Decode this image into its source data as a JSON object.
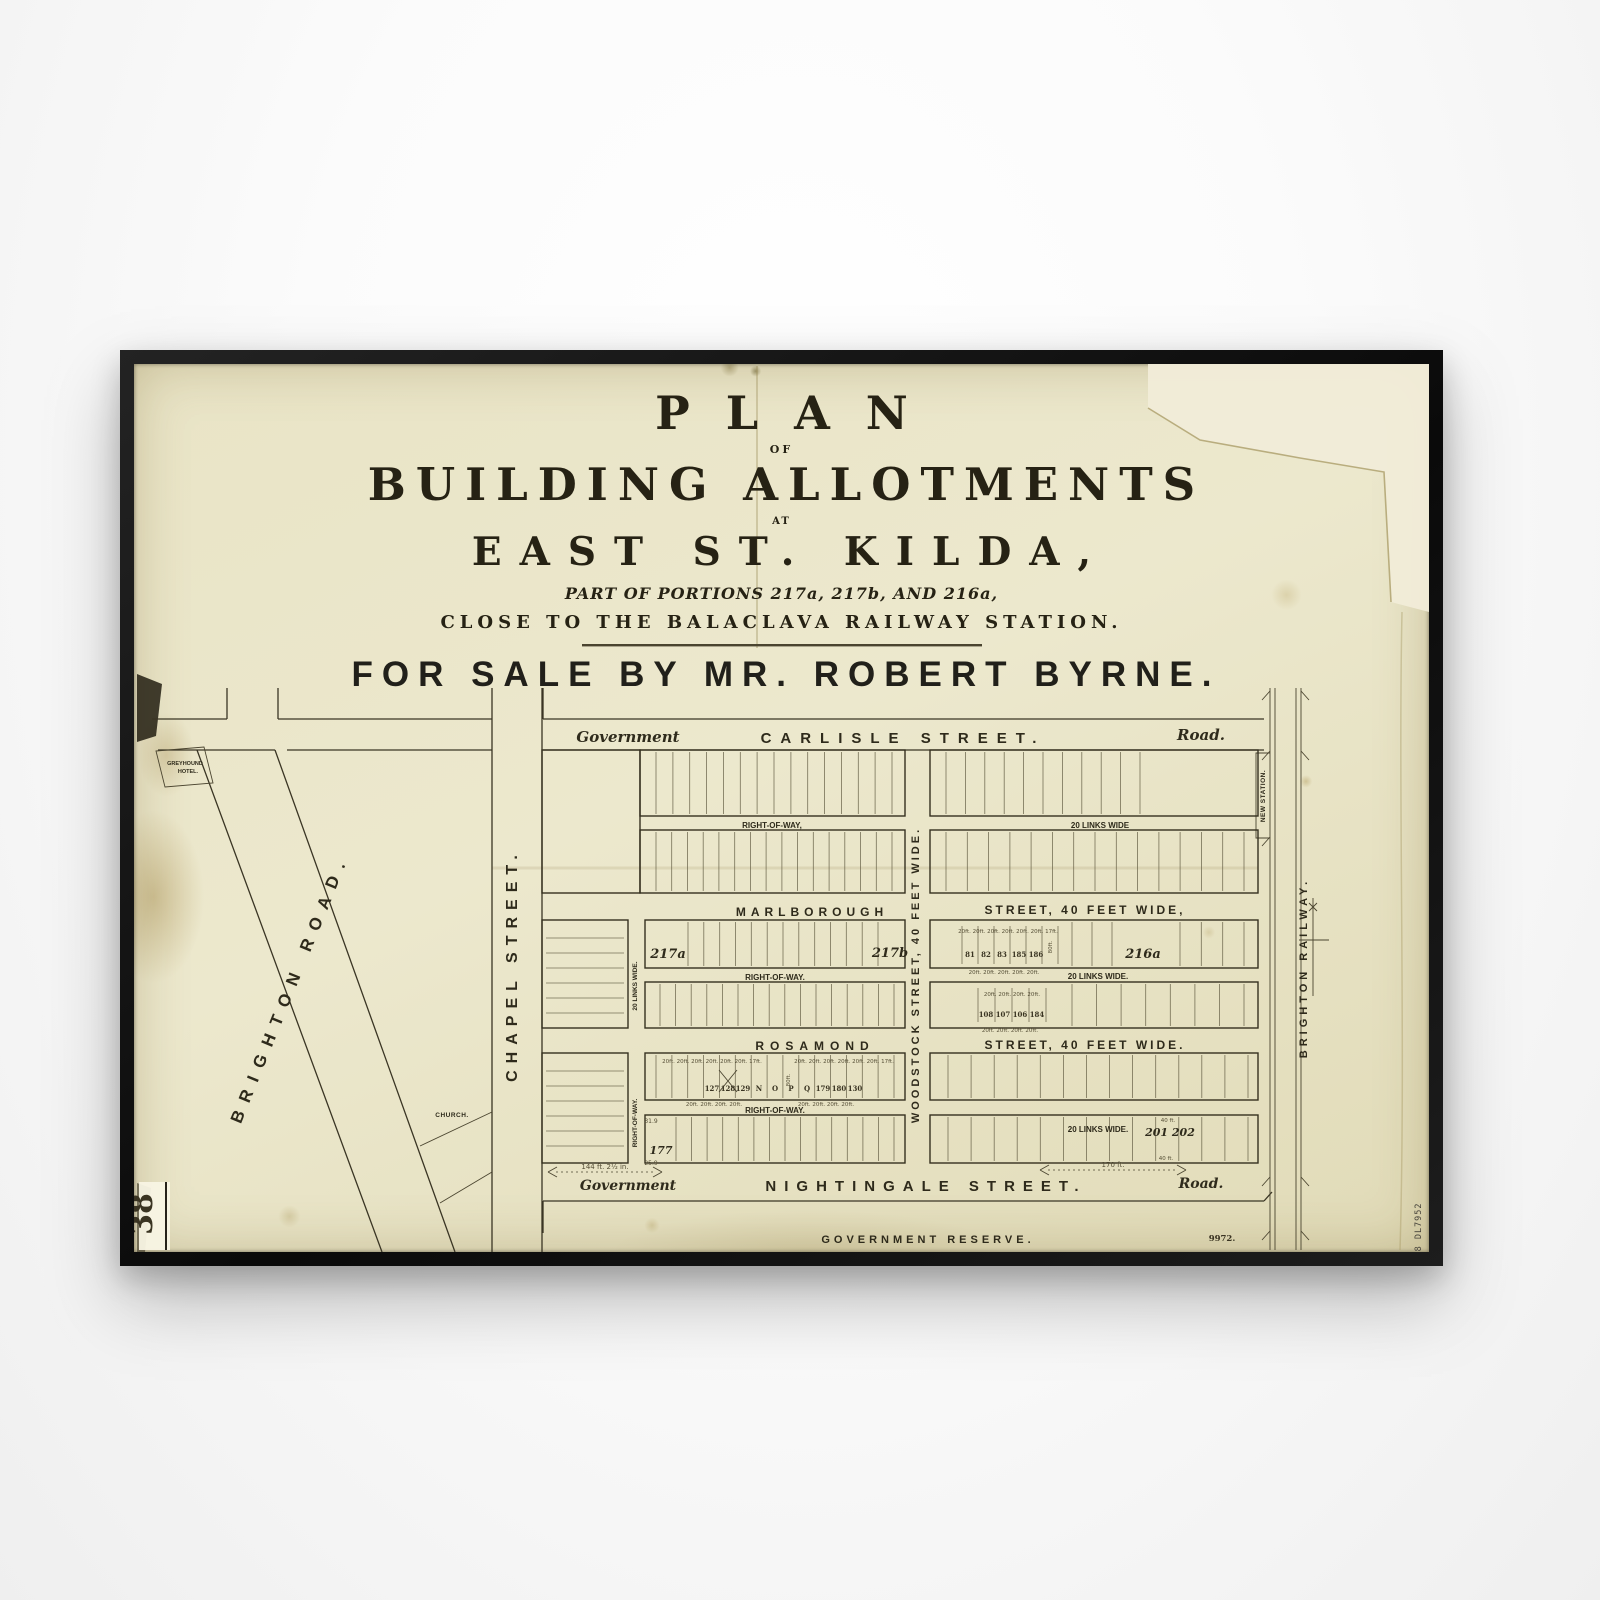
{
  "poster": {
    "title": {
      "plan": "PLAN",
      "of": "OF",
      "building_allotments": "BUILDING ALLOTMENTS",
      "at": "AT",
      "location": "EAST ST. KILDA,",
      "portions": "PART OF PORTIONS 217a, 217b, AND 216a,",
      "station_note": "CLOSE TO THE BALACLAVA RAILWAY STATION.",
      "sale_line": "FOR SALE BY MR. ROBERT BYRNE."
    },
    "streets": {
      "carlisle": "CARLISLE STREET.",
      "marlborough": "MARLBOROUGH",
      "marlborough_suffix": "STREET, 40 FEET WIDE,",
      "rosamond": "ROSAMOND",
      "rosamond_suffix": "STREET, 40 FEET WIDE.",
      "nightingale": "NIGHTINGALE STREET.",
      "woodstock": "WOODSTOCK STREET, 40 FEET WIDE.",
      "chapel": "CHAPEL STREET.",
      "brighton_road": "BRIGHTON ROAD.",
      "brighton_railway": "BRIGHTON RAILWAY.",
      "government": "Government",
      "road": "Road.",
      "government_reserve": "GOVERNMENT RESERVE."
    },
    "annotations": {
      "right_of_way_comma": "RIGHT-OF-WAY,",
      "right_of_way": "RIGHT-OF-WAY.",
      "links_wide": "20 LINKS WIDE",
      "links_wide_dot": "20 LINKS WIDE.",
      "new_station": "NEW STATION.",
      "greyhound_hotel_line1": "GREYHOUND",
      "greyhound_hotel_line2": "HOTEL.",
      "church": "CHURCH.",
      "portion_217a": "217a",
      "portion_217b": "217b",
      "portion_216a": "216a",
      "lot_201_202": "201 202",
      "lot_177": "177",
      "dim_left": "144 ft. 2½ in.",
      "dim_right": "170 ft.",
      "dim_40ft": "40 ft.",
      "dim_31_9": "31.9",
      "dim_25_9": "25.9",
      "dims_seven": "20ft. 20ft. 20ft. 20ft. 20ft. 20ft. 17ft.",
      "dims_five": "20ft. 20ft. 20ft. 20ft. 20ft.",
      "dims_four": "20ft. 20ft. 20ft. 20ft.",
      "dim_80ft": "80ft.",
      "plan_number": "9972.",
      "sheet_number": "38",
      "stamp": "88 DL7952"
    },
    "lots": {
      "marlborough_east_upper": [
        "81",
        "82",
        "83",
        "185",
        "186"
      ],
      "marlborough_east_lower": [
        "108",
        "107",
        "106",
        "184"
      ],
      "rosamond_west": [
        "127",
        "128",
        "129",
        "N",
        "O",
        "P",
        "Q",
        "179",
        "180",
        "130"
      ]
    },
    "colors": {
      "paper": "#e9e4c6",
      "ink": "#2e2a1b",
      "frame": "#111111",
      "tear_backing": "#f1ecd8"
    }
  }
}
